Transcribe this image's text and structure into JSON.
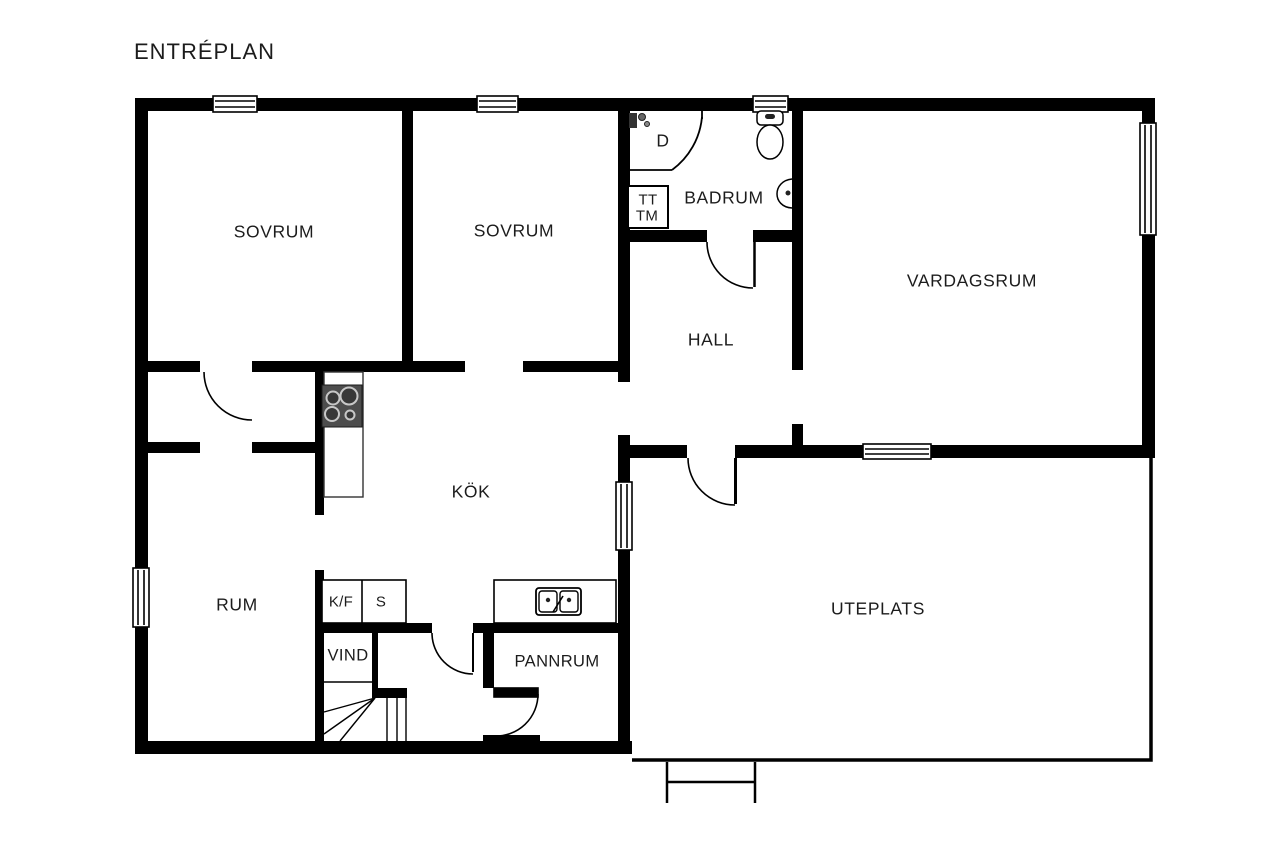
{
  "title": "ENTRÉPLAN",
  "rooms": {
    "sovrum1": "SOVRUM",
    "sovrum2": "SOVRUM",
    "badrum": "BADRUM",
    "hall": "HALL",
    "vardagsrum": "VARDAGSRUM",
    "kok": "KÖK",
    "rum": "RUM",
    "vind": "VIND",
    "pannrum": "PANNRUM",
    "uteplats": "UTEPLATS"
  },
  "fixtures": {
    "shower": "D",
    "towel_dryer": "TT",
    "washing_machine": "TM",
    "fridge_freezer": "K/F",
    "pantry": "S"
  },
  "colors": {
    "wall": "#000000",
    "background": "#ffffff",
    "stove_body": "#4d4d4d",
    "text": "#1c1c1c"
  }
}
